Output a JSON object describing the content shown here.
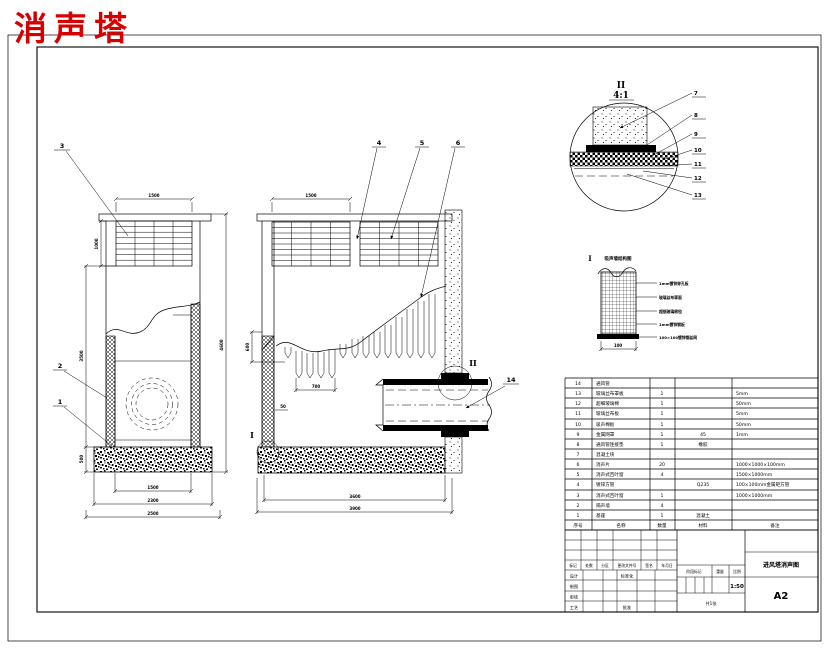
{
  "drawing_title": {
    "text": "消声塔",
    "color": "#d60000"
  },
  "section_markers": {
    "detail1": "I",
    "detail2": "II"
  },
  "callouts": {
    "n1": "1",
    "n2": "2",
    "n3": "3",
    "n4": "4",
    "n5": "5",
    "n6": "6",
    "n14": "14"
  },
  "detail_ii": {
    "label": "II",
    "scale": "4:1",
    "callouts": [
      "7",
      "8",
      "9",
      "10",
      "11",
      "12",
      "13"
    ]
  },
  "detail_i": {
    "marker": "I",
    "title": "吸声墙结构图",
    "width_dim": "100",
    "layers": [
      "1mm镀锌穿孔板",
      "玻璃丝布罩面",
      "超细玻璃棉毡",
      "1mm镀锌钢板",
      "100×100镀锌钢丝网"
    ]
  },
  "dimensions": {
    "left_view": {
      "grille_width": "1500",
      "grille_height": "1000",
      "height_left": "3500",
      "base_height": "500",
      "height_right": "4600",
      "width_inner": "1500",
      "width_mid": "2300",
      "width_outer": "2500"
    },
    "section_view": {
      "panel_width": "1500",
      "wedge_height": "600",
      "wedge_span": "700",
      "wall_thk": "50",
      "width_inner": "3600",
      "width_outer": "3900"
    }
  },
  "bom": {
    "headers": [
      "序号",
      "名称",
      "数量",
      "材料",
      "备注"
    ],
    "rows": [
      [
        "14",
        "通风管",
        "",
        "",
        ""
      ],
      [
        "13",
        "玻璃丝布罩板",
        "1",
        "",
        "5mm"
      ],
      [
        "12",
        "超细玻璃棉",
        "1",
        "",
        "50mm"
      ],
      [
        "11",
        "玻璃丝布板",
        "1",
        "",
        "5mm"
      ],
      [
        "10",
        "吸声棉板",
        "1",
        "",
        "50mm"
      ],
      [
        "9",
        "金属网罩",
        "1",
        "45",
        "1mm"
      ],
      [
        "8",
        "通风管连接垫",
        "1",
        "橡胶",
        ""
      ],
      [
        "7",
        "混凝土块",
        "",
        "",
        ""
      ],
      [
        "6",
        "消声片",
        "20",
        "",
        "1000×1000×100mm"
      ],
      [
        "5",
        "消声式百叶窗",
        "4",
        "",
        "1500×1000mm"
      ],
      [
        "4",
        "镀锌方管",
        "",
        "Q235",
        "100×100mm金属矩方管"
      ],
      [
        "3",
        "消声式百叶窗",
        "1",
        "",
        "1000×1000mm"
      ],
      [
        "2",
        "隔声墙",
        "4",
        "",
        ""
      ],
      [
        "1",
        "基座",
        "1",
        "混凝土",
        ""
      ]
    ]
  },
  "title_block": {
    "rev_headers": [
      "标记",
      "处数",
      "分区",
      "更改文件号",
      "签名",
      "年月日"
    ],
    "roles": [
      "设计",
      "制图",
      "审核",
      "工艺"
    ],
    "aux_roles": [
      "标准化",
      "批准"
    ],
    "stage_headers": [
      "阶段标记",
      "重量",
      "比例"
    ],
    "scale": "1:50",
    "sheet_note": "共1张",
    "drawing_name": "进风塔消声图",
    "paper_size": "A2"
  }
}
